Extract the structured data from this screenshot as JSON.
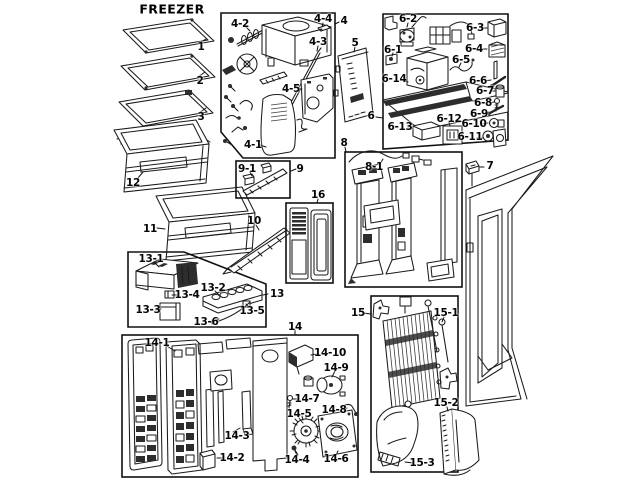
{
  "title": "FREEZER",
  "colors": {
    "background": "#ffffff",
    "line": "#1b1b1b",
    "dark_fill": "#2d2d2d"
  },
  "diagram": {
    "labels": [
      {
        "t": "1",
        "x": 201,
        "y": 47
      },
      {
        "t": "2",
        "x": 200,
        "y": 81
      },
      {
        "t": "3",
        "x": 201,
        "y": 117
      },
      {
        "t": "12",
        "x": 133,
        "y": 183
      },
      {
        "t": "11",
        "x": 150,
        "y": 229
      },
      {
        "t": "13-1",
        "x": 151,
        "y": 259
      },
      {
        "t": "13-4",
        "x": 187,
        "y": 295
      },
      {
        "t": "13-2",
        "x": 213,
        "y": 288
      },
      {
        "t": "13-3",
        "x": 148,
        "y": 310
      },
      {
        "t": "13-5",
        "x": 252,
        "y": 311
      },
      {
        "t": "13-6",
        "x": 206,
        "y": 322
      },
      {
        "t": "13",
        "x": 277,
        "y": 294
      },
      {
        "t": "14-1",
        "x": 157,
        "y": 343
      },
      {
        "t": "14-2",
        "x": 232,
        "y": 458
      },
      {
        "t": "14-3",
        "x": 237,
        "y": 436
      },
      {
        "t": "14",
        "x": 295,
        "y": 327
      },
      {
        "t": "14-10",
        "x": 330,
        "y": 353
      },
      {
        "t": "14-9",
        "x": 336,
        "y": 368
      },
      {
        "t": "14-7",
        "x": 307,
        "y": 399
      },
      {
        "t": "14-8",
        "x": 334,
        "y": 410
      },
      {
        "t": "14-5",
        "x": 299,
        "y": 414
      },
      {
        "t": "14-4",
        "x": 297,
        "y": 460
      },
      {
        "t": "14-6",
        "x": 336,
        "y": 459
      },
      {
        "t": "4-2",
        "x": 240,
        "y": 24
      },
      {
        "t": "4-4",
        "x": 323,
        "y": 19
      },
      {
        "t": "4",
        "x": 344,
        "y": 21
      },
      {
        "t": "4-3",
        "x": 318,
        "y": 42
      },
      {
        "t": "5",
        "x": 355,
        "y": 43
      },
      {
        "t": "4-5",
        "x": 291,
        "y": 89
      },
      {
        "t": "4-1",
        "x": 253,
        "y": 145
      },
      {
        "t": "6-2",
        "x": 408,
        "y": 19
      },
      {
        "t": "6-3",
        "x": 475,
        "y": 28
      },
      {
        "t": "6-1",
        "x": 393,
        "y": 50
      },
      {
        "t": "6-4",
        "x": 474,
        "y": 49
      },
      {
        "t": "6-5",
        "x": 461,
        "y": 60
      },
      {
        "t": "6-6",
        "x": 478,
        "y": 81
      },
      {
        "t": "6-14",
        "x": 394,
        "y": 79
      },
      {
        "t": "6-7",
        "x": 485,
        "y": 91
      },
      {
        "t": "6-8",
        "x": 483,
        "y": 103
      },
      {
        "t": "6-9",
        "x": 479,
        "y": 114
      },
      {
        "t": "6-10",
        "x": 474,
        "y": 124
      },
      {
        "t": "6-13",
        "x": 400,
        "y": 127
      },
      {
        "t": "6-12",
        "x": 449,
        "y": 119
      },
      {
        "t": "6-11",
        "x": 470,
        "y": 137
      },
      {
        "t": "6",
        "x": 371,
        "y": 116
      },
      {
        "t": "7",
        "x": 490,
        "y": 166
      },
      {
        "t": "8",
        "x": 344,
        "y": 143
      },
      {
        "t": "8-1",
        "x": 374,
        "y": 167
      },
      {
        "t": "9-1",
        "x": 247,
        "y": 169
      },
      {
        "t": "9",
        "x": 300,
        "y": 169
      },
      {
        "t": "16",
        "x": 318,
        "y": 195
      },
      {
        "t": "10",
        "x": 254,
        "y": 221
      },
      {
        "t": "15",
        "x": 358,
        "y": 313
      },
      {
        "t": "15-1",
        "x": 446,
        "y": 313
      },
      {
        "t": "15-2",
        "x": 446,
        "y": 403
      },
      {
        "t": "15-3",
        "x": 422,
        "y": 463
      }
    ]
  }
}
